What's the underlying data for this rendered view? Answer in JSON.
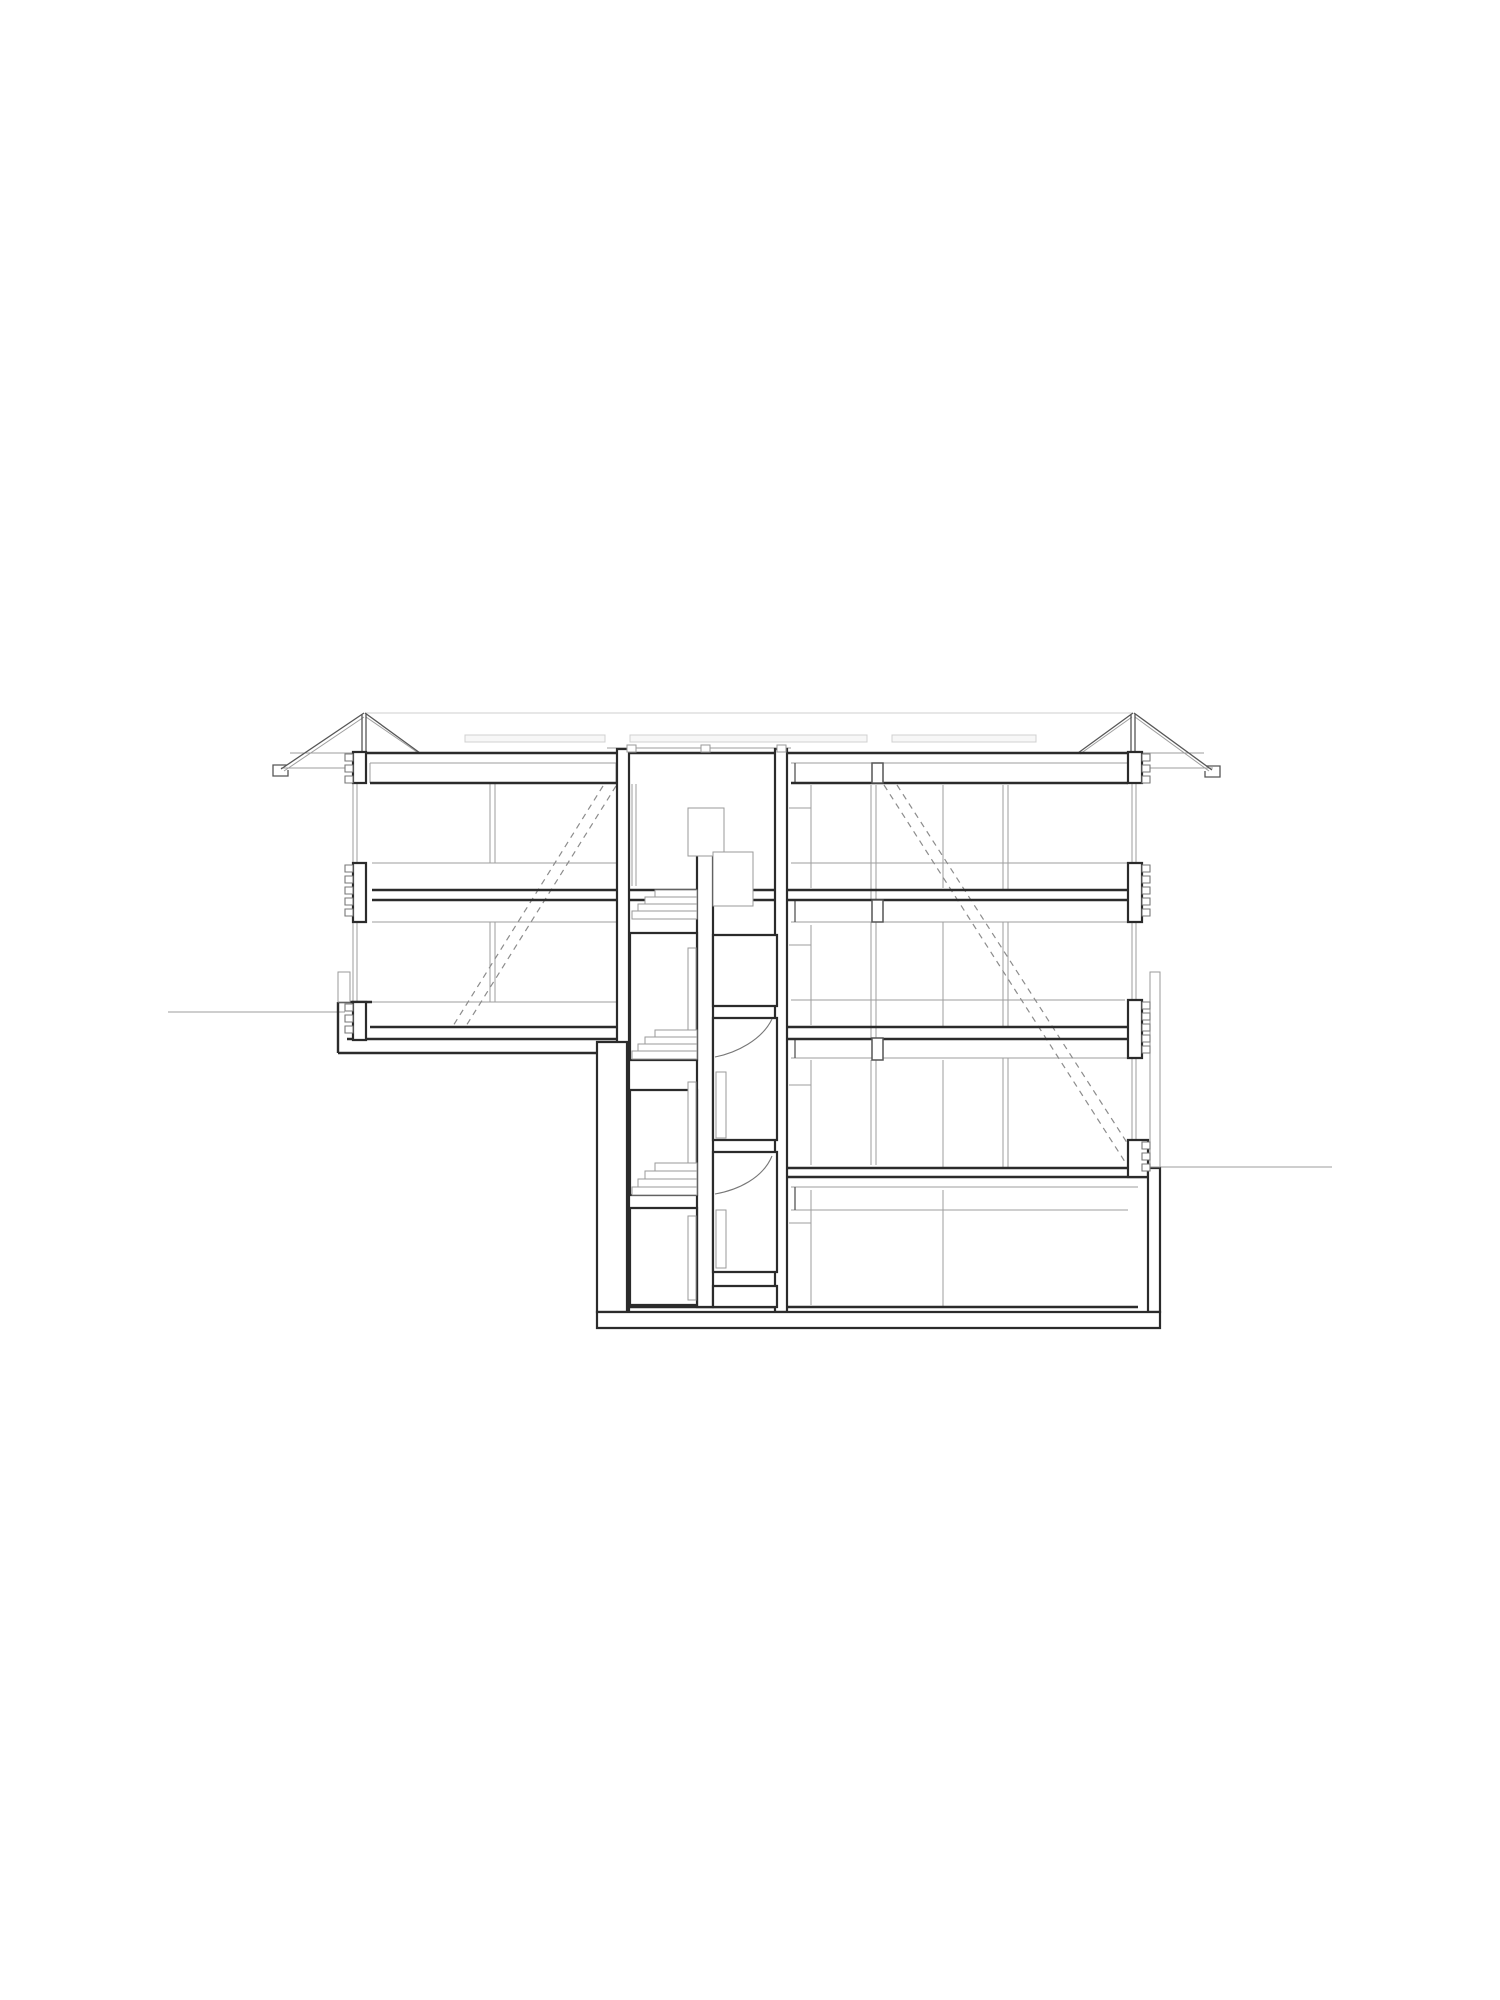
{
  "meta": {
    "type": "architectural-section-drawing",
    "description": "black-and-white building cross-section: gabled eave roof, two room wings, central staircase core with three flights and door swings, split ground levels, basement and foundation",
    "background_color": "#ffffff",
    "ink_color": "#2b2b2b",
    "canvas": {
      "width": 1500,
      "height": 2000
    }
  },
  "layers": [
    {
      "name": "roof-skylight-strips",
      "kind": "rect",
      "cls": "sky",
      "items": [
        [
          465,
          735,
          140,
          7
        ],
        [
          630,
          735,
          237,
          7
        ],
        [
          892,
          735,
          144,
          7
        ]
      ]
    },
    {
      "name": "roof-ridge-line",
      "kind": "line",
      "cls": "xlight",
      "items": [
        [
          365,
          713,
          1133,
          713
        ]
      ]
    },
    {
      "name": "elevation-light-lines",
      "kind": "line",
      "cls": "light",
      "items": [
        [
          281,
          768,
          353,
          768
        ],
        [
          1148,
          768,
          1213,
          768
        ],
        [
          290,
          753,
          360,
          753
        ],
        [
          1140,
          753,
          1204,
          753
        ],
        [
          607,
          748,
          791,
          748
        ],
        [
          370,
          763,
          617,
          763
        ],
        [
          791,
          763,
          1128,
          763
        ],
        [
          370,
          763,
          370,
          783
        ],
        [
          616,
          763,
          616,
          783
        ],
        [
          372,
          863,
          617,
          863
        ],
        [
          791,
          863,
          1128,
          863
        ],
        [
          372,
          922,
          617,
          922
        ],
        [
          791,
          922,
          1128,
          922
        ],
        [
          338,
          1002,
          617,
          1002
        ],
        [
          791,
          1000,
          1125,
          1000
        ],
        [
          791,
          1058,
          1128,
          1058
        ],
        [
          791,
          1187,
          1138,
          1187
        ],
        [
          791,
          1210,
          1128,
          1210
        ],
        [
          168,
          1012,
          345,
          1012
        ],
        [
          1160,
          1167,
          1332,
          1167
        ],
        [
          353,
          768,
          353,
          1002
        ],
        [
          357,
          768,
          357,
          1002
        ],
        [
          1132,
          768,
          1132,
          1167
        ],
        [
          1136,
          768,
          1136,
          1167
        ],
        [
          490,
          784,
          490,
          863
        ],
        [
          495,
          784,
          495,
          863
        ],
        [
          490,
          922,
          490,
          1002
        ],
        [
          495,
          922,
          495,
          1002
        ],
        [
          1003,
          785,
          1003,
          890
        ],
        [
          1008,
          785,
          1008,
          890
        ],
        [
          1003,
          922,
          1003,
          1027
        ],
        [
          1008,
          922,
          1008,
          1027
        ],
        [
          1003,
          1058,
          1003,
          1168
        ],
        [
          1008,
          1058,
          1008,
          1168
        ],
        [
          871,
          785,
          871,
          900
        ],
        [
          876,
          785,
          876,
          900
        ],
        [
          871,
          922,
          871,
          1038
        ],
        [
          876,
          922,
          876,
          1038
        ],
        [
          871,
          1060,
          871,
          1165
        ],
        [
          876,
          1060,
          876,
          1165
        ],
        [
          811,
          785,
          811,
          888
        ],
        [
          811,
          925,
          811,
          1025
        ],
        [
          811,
          1060,
          811,
          1165
        ],
        [
          811,
          1190,
          811,
          1305
        ],
        [
          943,
          785,
          943,
          888
        ],
        [
          943,
          922,
          943,
          1027
        ],
        [
          943,
          1060,
          943,
          1168
        ],
        [
          943,
          1190,
          943,
          1307
        ],
        [
          789,
          808,
          811,
          808
        ],
        [
          789,
          945,
          811,
          945
        ],
        [
          789,
          1085,
          811,
          1085
        ],
        [
          789,
          1223,
          811,
          1223
        ],
        [
          632,
          784,
          632,
          886
        ],
        [
          636,
          784,
          636,
          886
        ],
        [
          632,
          944,
          632,
          1028
        ],
        [
          636,
          944,
          636,
          1028
        ],
        [
          632,
          1094,
          632,
          1160
        ],
        [
          636,
          1094,
          636,
          1160
        ],
        [
          284,
          771,
          364,
          717
        ],
        [
          366,
          717,
          417,
          752
        ],
        [
          1080,
          754,
          1132,
          717
        ],
        [
          1135,
          717,
          1209,
          771
        ]
      ]
    },
    {
      "name": "stair-run-dashed-lines",
      "kind": "line",
      "cls": "dashed",
      "items": [
        [
          616,
          786,
          466,
          1026
        ],
        [
          603,
          786,
          453,
          1026
        ],
        [
          884,
          785,
          1127,
          1165
        ],
        [
          897,
          785,
          1133,
          1152
        ]
      ]
    },
    {
      "name": "roof-monitor-lines",
      "kind": "line",
      "cls": "med",
      "items": [
        [
          281,
          769,
          364,
          713
        ],
        [
          365,
          713,
          420,
          753
        ],
        [
          1078,
          753,
          1133,
          713
        ],
        [
          1134,
          713,
          1212,
          770
        ],
        [
          362,
          714,
          362,
          752
        ],
        [
          366,
          714,
          366,
          752
        ],
        [
          1131,
          714,
          1131,
          752
        ],
        [
          1135,
          714,
          1135,
          752
        ],
        [
          795,
          763,
          795,
          783
        ],
        [
          795,
          900,
          795,
          922
        ],
        [
          795,
          1038,
          795,
          1058
        ],
        [
          795,
          1187,
          795,
          1210
        ]
      ]
    },
    {
      "name": "eave-gutters",
      "kind": "path",
      "cls": "med",
      "items": [
        "M287,765 L273,765 L273,776 L288,776 L288,770",
        "M1206,766 L1220,766 L1220,777 L1205,777 L1205,771"
      ]
    },
    {
      "name": "cut-slab-lines",
      "kind": "line",
      "cls": "heavy",
      "items": [
        [
          360,
          753,
          1128,
          753
        ],
        [
          370,
          783,
          617,
          783
        ],
        [
          791,
          783,
          1128,
          783
        ],
        [
          372,
          890,
          1140,
          890
        ],
        [
          372,
          900,
          1140,
          900
        ],
        [
          370,
          1027,
          1148,
          1027
        ],
        [
          347,
          1039,
          1148,
          1039
        ],
        [
          338,
          1053,
          597,
          1053
        ],
        [
          627,
          1168,
          1160,
          1168
        ],
        [
          627,
          1177,
          1160,
          1177
        ],
        [
          627,
          1307,
          1138,
          1307
        ],
        [
          338,
          1002,
          372,
          1002
        ],
        [
          338,
          1002,
          338,
          1053
        ]
      ]
    },
    {
      "name": "cut-wall-boxes",
      "kind": "rect",
      "cls": "wbox",
      "items": [
        [
          617,
          749,
          12,
          563
        ],
        [
          775,
          749,
          12,
          563
        ],
        [
          697,
          852,
          16,
          455
        ],
        [
          630,
          933,
          67,
          127
        ],
        [
          630,
          1090,
          67,
          105
        ],
        [
          630,
          1208,
          67,
          97
        ],
        [
          713,
          935,
          64,
          71
        ],
        [
          713,
          1018,
          64,
          122
        ],
        [
          713,
          1152,
          64,
          120
        ],
        [
          713,
          1286,
          64,
          21
        ],
        [
          353,
          752,
          13,
          31
        ],
        [
          353,
          863,
          13,
          59
        ],
        [
          353,
          1002,
          13,
          38
        ],
        [
          1128,
          752,
          14,
          31
        ],
        [
          1128,
          863,
          14,
          59
        ],
        [
          1128,
          1000,
          14,
          58
        ],
        [
          1128,
          1140,
          20,
          37
        ],
        [
          597,
          1042,
          30,
          270
        ],
        [
          1148,
          1168,
          12,
          144
        ],
        [
          597,
          1312,
          563,
          16
        ]
      ]
    },
    {
      "name": "light-detail-boxes",
      "kind": "rect",
      "cls": "lbox",
      "items": [
        [
          627,
          745,
          9,
          7
        ],
        [
          701,
          745,
          9,
          7
        ],
        [
          777,
          745,
          9,
          7
        ],
        [
          338,
          972,
          12,
          30
        ],
        [
          1150,
          972,
          10,
          195
        ],
        [
          688,
          808,
          36,
          48
        ],
        [
          713,
          852,
          40,
          54
        ],
        [
          688,
          948,
          8,
          110
        ],
        [
          688,
          1082,
          8,
          110
        ],
        [
          688,
          1216,
          8,
          84
        ],
        [
          716,
          1072,
          10,
          66
        ],
        [
          716,
          1210,
          10,
          58
        ]
      ]
    },
    {
      "name": "brick-toothing-marks",
      "kind": "rect",
      "cls": "tooth",
      "items": [
        [
          345,
          754,
          8,
          7
        ],
        [
          345,
          765,
          8,
          7
        ],
        [
          345,
          776,
          8,
          7
        ],
        [
          345,
          865,
          8,
          7
        ],
        [
          345,
          876,
          8,
          7
        ],
        [
          345,
          887,
          8,
          7
        ],
        [
          345,
          898,
          8,
          7
        ],
        [
          345,
          909,
          8,
          7
        ],
        [
          345,
          1004,
          8,
          7
        ],
        [
          345,
          1015,
          8,
          7
        ],
        [
          345,
          1026,
          8,
          7
        ],
        [
          1142,
          754,
          8,
          7
        ],
        [
          1142,
          765,
          8,
          7
        ],
        [
          1142,
          776,
          8,
          7
        ],
        [
          1142,
          865,
          8,
          7
        ],
        [
          1142,
          876,
          8,
          7
        ],
        [
          1142,
          887,
          8,
          7
        ],
        [
          1142,
          898,
          8,
          7
        ],
        [
          1142,
          909,
          8,
          7
        ],
        [
          1142,
          1002,
          8,
          7
        ],
        [
          1142,
          1013,
          8,
          7
        ],
        [
          1142,
          1024,
          8,
          7
        ],
        [
          1142,
          1035,
          8,
          7
        ],
        [
          1142,
          1046,
          8,
          7
        ],
        [
          1142,
          1142,
          8,
          7
        ],
        [
          1142,
          1153,
          8,
          7
        ],
        [
          1142,
          1164,
          8,
          7
        ]
      ]
    },
    {
      "name": "beam-piers",
      "kind": "rect",
      "cls": "pier",
      "items": [
        [
          872,
          763,
          11,
          20
        ],
        [
          872,
          900,
          11,
          22
        ],
        [
          872,
          1038,
          11,
          22
        ]
      ]
    },
    {
      "name": "stair-flight-steps",
      "kind": "rect",
      "cls": "step",
      "items": [
        [
          655,
          890,
          42,
          8
        ],
        [
          645,
          897,
          52,
          8
        ],
        [
          638,
          904,
          59,
          8
        ],
        [
          632,
          911,
          65,
          8
        ],
        [
          655,
          1030,
          42,
          7
        ],
        [
          645,
          1037,
          52,
          7
        ],
        [
          638,
          1044,
          59,
          7
        ],
        [
          632,
          1051,
          65,
          8
        ],
        [
          655,
          1163,
          42,
          8
        ],
        [
          645,
          1171,
          52,
          8
        ],
        [
          638,
          1179,
          59,
          8
        ],
        [
          632,
          1187,
          65,
          8
        ]
      ]
    },
    {
      "name": "door-swing-arcs",
      "kind": "path",
      "cls": "arc",
      "items": [
        "M715,1057 C736,1053 762,1040 772,1019",
        "M715,1194 C738,1190 763,1178 772,1156"
      ]
    }
  ]
}
